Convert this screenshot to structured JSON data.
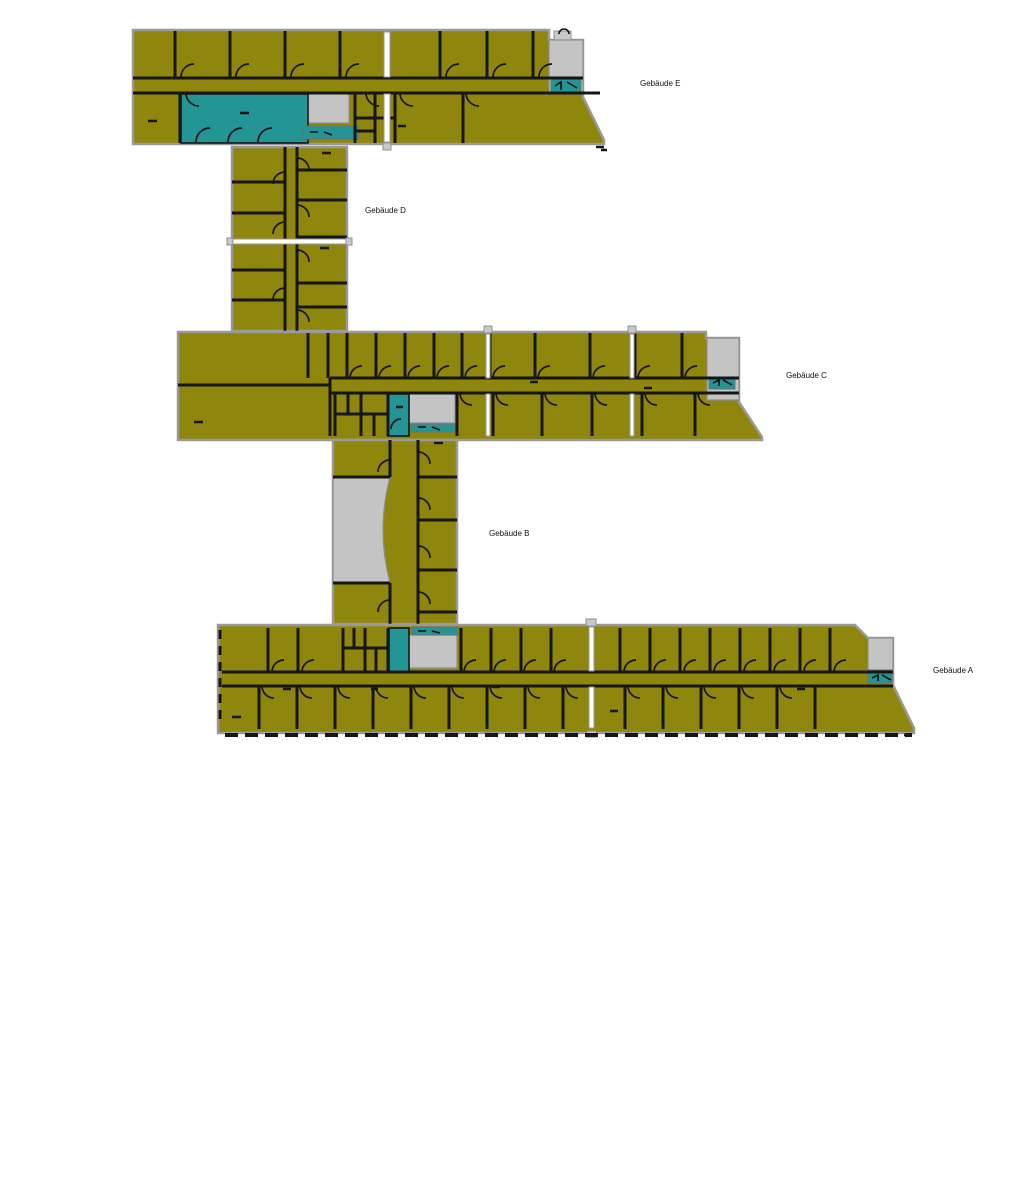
{
  "diagram": {
    "type": "architectural floor plan of a five-wing building complex",
    "background": "#ffffff"
  },
  "palette": {
    "room": "#8E860D",
    "special_room": "#249595",
    "stair_core": "#C4C4C4",
    "wall": "#161616",
    "outer_band": "#9A9A9A",
    "label_color": "#111111"
  },
  "buildings": [
    {
      "id": "E",
      "label": "Gebäude E"
    },
    {
      "id": "D",
      "label": "Gebäude D"
    },
    {
      "id": "C",
      "label": "Gebäude C"
    },
    {
      "id": "B",
      "label": "Gebäude B"
    },
    {
      "id": "A",
      "label": "Gebäude A"
    }
  ]
}
